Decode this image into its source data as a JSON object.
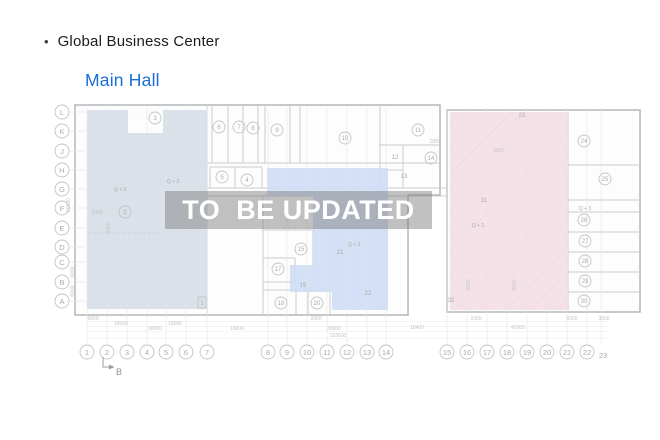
{
  "header": {
    "bullet": "•",
    "title": "Global Business Center",
    "subtitle": "Main Hall"
  },
  "watermark": {
    "text": "TO  BE UPDATED"
  },
  "plan": {
    "colors": {
      "left_zone": "#d5dde6",
      "middle_zone": "#cddcf4",
      "right_zone": "#f4dfe5",
      "subtitle": "#1a6dd4",
      "watermark_band": "rgba(125,125,125,0.48)",
      "watermark_text": "#ffffff",
      "wall": "#b3b6b9",
      "inner_wall": "#cacccf",
      "grid": "#e3e4e6",
      "label": "#a9abae",
      "circle_stroke": "#c2c4c6",
      "dim": "#c2c4c7"
    },
    "grid": {
      "cols": [
        {
          "t": "1",
          "x": 87
        },
        {
          "t": "2",
          "x": 107
        },
        {
          "t": "3",
          "x": 127
        },
        {
          "t": "4",
          "x": 147
        },
        {
          "t": "5",
          "x": 166
        },
        {
          "t": "6",
          "x": 186
        },
        {
          "t": "7",
          "x": 207
        },
        {
          "t": "8",
          "x": 268
        },
        {
          "t": "9",
          "x": 287
        },
        {
          "t": "10",
          "x": 307
        },
        {
          "t": "11",
          "x": 327
        },
        {
          "t": "12",
          "x": 347
        },
        {
          "t": "13",
          "x": 367
        },
        {
          "t": "14",
          "x": 386
        },
        {
          "t": "15",
          "x": 447
        },
        {
          "t": "16",
          "x": 467
        },
        {
          "t": "17",
          "x": 487
        },
        {
          "t": "18",
          "x": 507
        },
        {
          "t": "19",
          "x": 527
        },
        {
          "t": "20",
          "x": 547
        },
        {
          "t": "21",
          "x": 567
        },
        {
          "t": "22",
          "x": 587
        },
        {
          "t": "23",
          "x": 601,
          "plain": true
        }
      ],
      "rows": [
        {
          "t": "L",
          "y": 112
        },
        {
          "t": "K",
          "y": 131
        },
        {
          "t": "J",
          "y": 151
        },
        {
          "t": "H",
          "y": 170
        },
        {
          "t": "G",
          "y": 189
        },
        {
          "t": "F",
          "y": 208
        },
        {
          "t": "E",
          "y": 228
        },
        {
          "t": "D",
          "y": 247
        },
        {
          "t": "C",
          "y": 262
        },
        {
          "t": "B",
          "y": 282
        },
        {
          "t": "A",
          "y": 301
        }
      ]
    },
    "rooms": [
      {
        "n": "1",
        "x": 202,
        "y": 303,
        "shape": "square"
      },
      {
        "n": "2",
        "x": 125,
        "y": 212
      },
      {
        "n": "3",
        "x": 155,
        "y": 118
      },
      {
        "n": "4",
        "x": 247,
        "y": 180
      },
      {
        "n": "5",
        "x": 222,
        "y": 177
      },
      {
        "n": "6",
        "x": 219,
        "y": 127
      },
      {
        "n": "7",
        "x": 239,
        "y": 127
      },
      {
        "n": "8",
        "x": 253,
        "y": 128
      },
      {
        "n": "9",
        "x": 277,
        "y": 130
      },
      {
        "n": "10",
        "x": 345,
        "y": 138
      },
      {
        "n": "11",
        "x": 418,
        "y": 130
      },
      {
        "n": "12",
        "x": 395,
        "y": 157,
        "shape": "plain"
      },
      {
        "n": "13",
        "x": 404,
        "y": 176,
        "shape": "plain"
      },
      {
        "n": "14",
        "x": 431,
        "y": 158
      },
      {
        "n": "15",
        "x": 301,
        "y": 249
      },
      {
        "n": "17",
        "x": 278,
        "y": 269
      },
      {
        "n": "18",
        "x": 281,
        "y": 303
      },
      {
        "n": "19",
        "x": 303,
        "y": 285,
        "shape": "plain"
      },
      {
        "n": "20",
        "x": 317,
        "y": 303
      },
      {
        "n": "21",
        "x": 340,
        "y": 252,
        "shape": "plain"
      },
      {
        "n": "22",
        "x": 368,
        "y": 293,
        "shape": "plain"
      },
      {
        "n": "23",
        "x": 522,
        "y": 115,
        "shape": "plain"
      },
      {
        "n": "24",
        "x": 584,
        "y": 141
      },
      {
        "n": "25",
        "x": 605,
        "y": 179
      },
      {
        "n": "26",
        "x": 584,
        "y": 220
      },
      {
        "n": "27",
        "x": 585,
        "y": 241
      },
      {
        "n": "28",
        "x": 585,
        "y": 261
      },
      {
        "n": "29",
        "x": 585,
        "y": 281
      },
      {
        "n": "30",
        "x": 584,
        "y": 301
      },
      {
        "n": "31",
        "x": 484,
        "y": 200,
        "shape": "plain"
      },
      {
        "n": "32",
        "x": 451,
        "y": 300,
        "shape": "plain"
      }
    ],
    "area_labels": [
      {
        "t": "Q + 3",
        "x": 120,
        "y": 191
      },
      {
        "t": "Q + 3",
        "x": 173,
        "y": 183
      },
      {
        "t": "Q + 3",
        "x": 354,
        "y": 246
      },
      {
        "t": "Q + 3",
        "x": 478,
        "y": 227
      },
      {
        "t": "Q + 3",
        "x": 585,
        "y": 210
      }
    ],
    "dim_labels": [
      {
        "t": "6000",
        "x": 93,
        "y": 320
      },
      {
        "t": "2000",
        "x": 316,
        "y": 320
      },
      {
        "t": "1000",
        "x": 476,
        "y": 320
      },
      {
        "t": "6000",
        "x": 572,
        "y": 320
      },
      {
        "t": "3000",
        "x": 604,
        "y": 320
      },
      {
        "t": "18000",
        "x": 121,
        "y": 325
      },
      {
        "t": "18000",
        "x": 175,
        "y": 325
      },
      {
        "t": "36000",
        "x": 155,
        "y": 330
      },
      {
        "t": "18000",
        "x": 237,
        "y": 330
      },
      {
        "t": "36000",
        "x": 334,
        "y": 330
      },
      {
        "t": "18400",
        "x": 417,
        "y": 329
      },
      {
        "t": "45000",
        "x": 518,
        "y": 329
      },
      {
        "t": "153600",
        "x": 338,
        "y": 337
      }
    ],
    "small_dims": [
      {
        "t": "60000",
        "x": 70,
        "y": 205,
        "rot": true
      },
      {
        "t": "6000",
        "x": 74,
        "y": 272,
        "rot": true
      },
      {
        "t": "6000",
        "x": 74,
        "y": 291,
        "rot": true
      },
      {
        "t": "5000",
        "x": 110,
        "y": 228,
        "rot": true
      },
      {
        "t": "6000",
        "x": 470,
        "y": 285,
        "rot": true
      },
      {
        "t": "6000",
        "x": 516,
        "y": 285,
        "rot": true
      },
      {
        "t": "2000",
        "x": 97,
        "y": 214
      },
      {
        "t": "1800",
        "x": 435,
        "y": 143
      },
      {
        "t": "1800",
        "x": 498,
        "y": 152
      }
    ],
    "dim_lines": [
      321.5,
      326.5,
      331.5,
      338.5
    ],
    "section_marker": {
      "label": "B"
    }
  }
}
